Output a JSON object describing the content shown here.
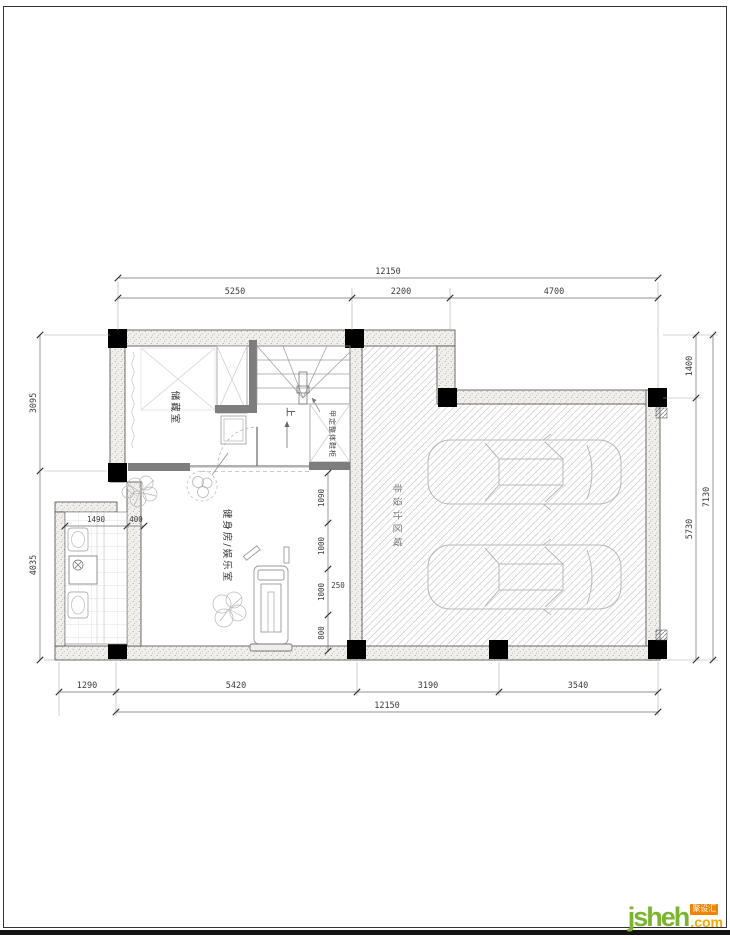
{
  "drawing": {
    "rooms": {
      "storage": "储藏室",
      "gym": "健身房/娱乐室",
      "garage": "非设计区域",
      "shoe_cabinet": "甲定整体鞋柜",
      "stair_up": "上"
    },
    "dims": {
      "top_total": "12150",
      "top_chain": [
        "5250",
        "2200",
        "4700"
      ],
      "left_chain": [
        "3095",
        "4035"
      ],
      "right_chain": [
        "1400",
        "5730"
      ],
      "right_total": "7130",
      "bottom_chain": [
        "1290",
        "5420",
        "3190",
        "3540"
      ],
      "bottom_total": "12150",
      "inner_chain": [
        "1090",
        "1000",
        "1000",
        "800"
      ],
      "inner_gap": "250",
      "laundry_width": "1490",
      "wall_offset": "400"
    }
  },
  "footer": {
    "logo_name": "jsheh",
    "logo_tld": ".com",
    "logo_badge": "聚设汇"
  }
}
